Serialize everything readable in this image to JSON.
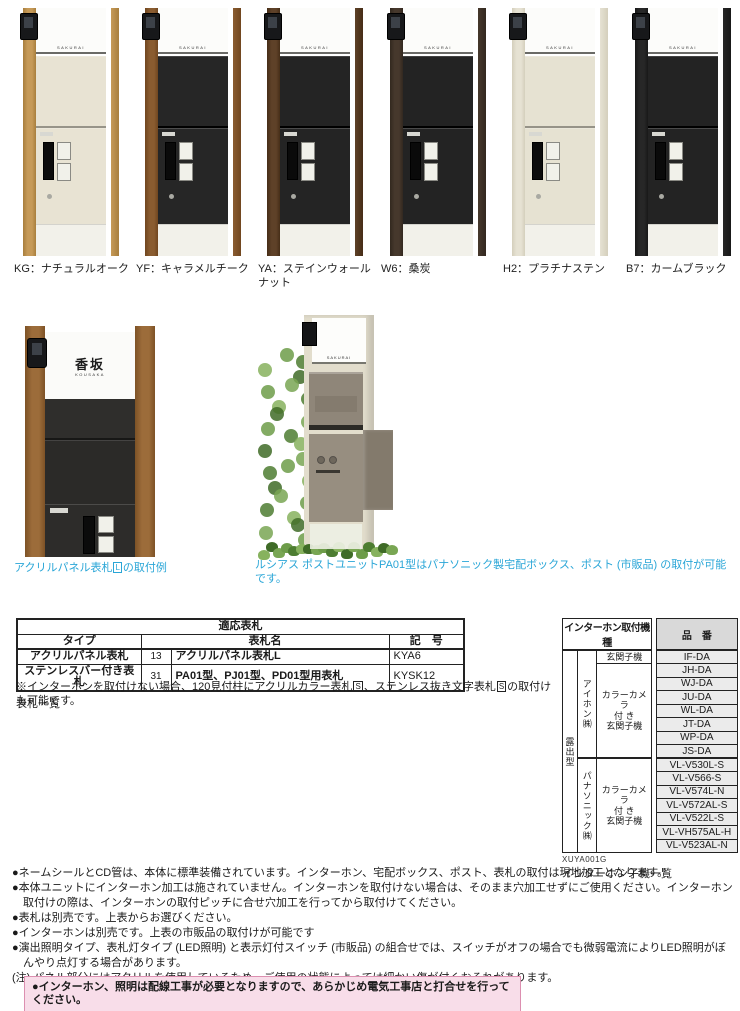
{
  "products": {
    "nameplate": "SAKURAI",
    "items": [
      {
        "label": "KG：ナチュラルオーク",
        "post": "#c69a58",
        "grain": "#a87e3d",
        "panel": "#e8e3d3",
        "dark_body": false
      },
      {
        "label": "YF：キャラメルチーク",
        "post": "#8a5c30",
        "grain": "#70461f",
        "panel": "#262626",
        "dark_body": true
      },
      {
        "label": "YA：ステインウォールナット",
        "post": "#5e4128",
        "grain": "#462d17",
        "panel": "#242424",
        "dark_body": true
      },
      {
        "label": "W6：桑炭",
        "post": "#46382c",
        "grain": "#32281f",
        "panel": "#232323",
        "dark_body": true
      },
      {
        "label": "H2：プラチナステン",
        "post": "#e6e2d3",
        "grain": "#d4cfbc",
        "panel": "#e6e2d2",
        "dark_body": false
      },
      {
        "label": "B7：カームブラック",
        "post": "#272727",
        "grain": "#181818",
        "panel": "#232323",
        "dark_body": true
      }
    ]
  },
  "examples": {
    "caption_color": "#2aa6d7",
    "left_caption": {
      "pre": "アクリルパネル表札",
      "boxed": "L",
      "post": "の取付例"
    },
    "left_nameplate": {
      "kanji": "香坂",
      "roman": "KOUSAKA"
    },
    "right_caption": "ルシアス ポストユニットPA01型はパナソニック製宅配ボックス、ポスト (市販品) の取付が可能です。"
  },
  "plate_table": {
    "title": "適応表札",
    "col_type": "タイプ",
    "col_name": "表札名",
    "col_code": "記　号",
    "rows": [
      {
        "type": "アクリルパネル表札",
        "page": "13",
        "name": "アクリルパネル表札L",
        "code": "KYA6"
      },
      {
        "type": "ステンレスバー付き表札",
        "page": "31",
        "name": "PA01型、PJ01型、PD01型用表札",
        "code": "KYSK12"
      }
    ],
    "note_segments": [
      {
        "t": "※インターホンを取付けない場合、120見付柱にアクリルカラー表札"
      },
      {
        "b": "S"
      },
      {
        "t": "、ステンレス抜き文字表札"
      },
      {
        "b": "S"
      },
      {
        "t": "の取付けも可能です。"
      }
    ],
    "below_label": "表札一覧"
  },
  "intercom_table": {
    "title": "インターホン取付機種",
    "col_part": "品　番",
    "mount_type": "露出型",
    "makers": [
      {
        "name": "アイホン㈱",
        "groups": [
          {
            "type": "玄関子機",
            "parts": [
              "IF-DA"
            ]
          },
          {
            "type": "カラーカメラ\n付 き\n玄関子機",
            "parts": [
              "JH-DA",
              "WJ-DA",
              "JU-DA",
              "WL-DA",
              "JT-DA",
              "WP-DA",
              "JS-DA"
            ]
          }
        ]
      },
      {
        "name": "パナソニック㈱",
        "groups": [
          {
            "type": "カラーカメラ\n付 き\n玄関子機",
            "parts": [
              "VL-V530L-S",
              "VL-V566-S",
              "VL-V574L-N",
              "VL-V572AL-S",
              "VL-V522L-S",
              "VL-VH575AL-H",
              "VL-V523AL-N"
            ]
          }
        ]
      }
    ],
    "ref_code": "XUYA001G",
    "below_label": "インターホン子機一覧"
  },
  "notes": {
    "items": [
      "●ネームシールとCD管は、本体に標準装備されています。インターホン、宅配ボックス、ポスト、表札の取付は現地加工となります。",
      "●本体ユニットにインターホン加工は施されていません。インターホンを取付けない場合は、そのまま穴加工せずにご使用ください。インターホン取付けの際は、インターホンの取付ピッチに合せ穴加工を行ってから取付けてください。",
      "●表札は別売です。上表からお選びください。",
      "●インターホンは別売です。上表の市販品の取付けが可能です",
      "●演出照明タイプ、表札灯タイプ (LED照明) と表示灯付スイッチ (市販品) の組合せでは、スイッチがオフの場合でも微弱電流によりLED照明がぼんやり点灯する場合があります。",
      "(注) パネル部分にはアクリルを使用しているため、ご使用の状態によっては細かい傷が付くおそれがあります。"
    ],
    "warning": "●インターホン、照明は配線工事が必要となりますので、あらかじめ電気工事店と打合せを行ってください。",
    "warning_bg": "#f8dde9",
    "warning_border": "#dc8fb0"
  }
}
